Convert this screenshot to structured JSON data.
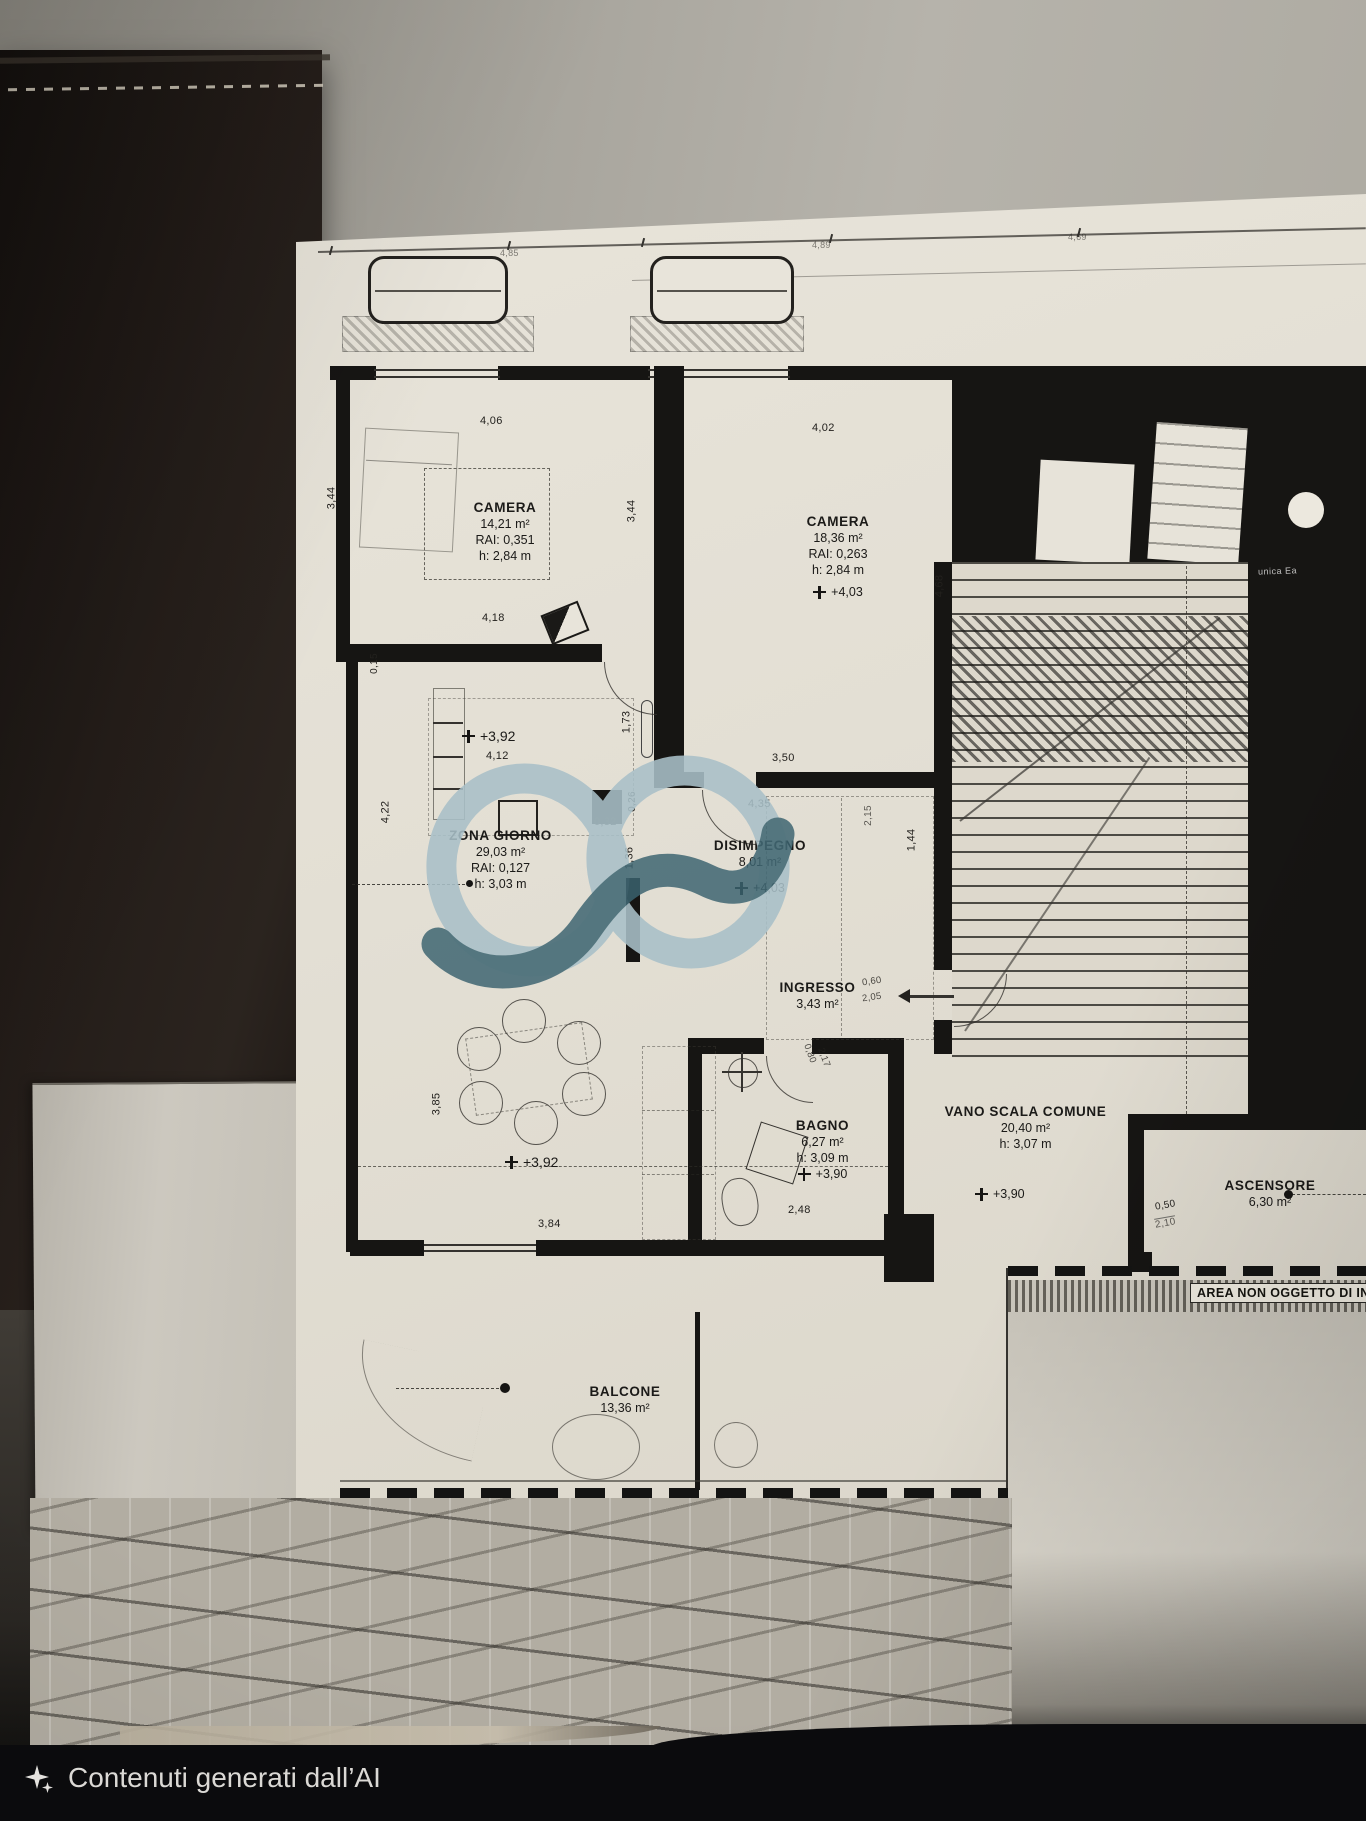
{
  "scene": {
    "caption_text": "Contenuti generati dall’AI",
    "micro_label": "unica Ea"
  },
  "watermark": {
    "light_color": "#a9c0c8",
    "dark_color": "#3b6370"
  },
  "plan": {
    "rooms": {
      "camera1": {
        "name": "CAMERA",
        "area": "14,21 m²",
        "rai": "RAI: 0,351",
        "height": "h: 2,84 m"
      },
      "camera2": {
        "name": "CAMERA",
        "area": "18,36 m²",
        "rai": "RAI: 0,263",
        "height": "h: 2,84 m",
        "quota": "+4,03"
      },
      "zona_giorno": {
        "name": "ZONA GIORNO",
        "area": "29,03 m²",
        "rai": "RAI: 0,127",
        "height": "h: 3,03 m"
      },
      "disimpegno": {
        "name": "DISIMPEGNO",
        "area": "8,01 m²",
        "quota": "+4,03"
      },
      "ingresso": {
        "name": "INGRESSO",
        "area": "3,43 m²"
      },
      "bagno": {
        "name": "BAGNO",
        "area": "6,27 m²",
        "height": "h: 3,09 m",
        "quota": "+3,90"
      },
      "vano_scala": {
        "name": "VANO SCALA COMUNE",
        "area": "20,40 m²",
        "height": "h: 3,07 m",
        "quota": "+3,90"
      },
      "ascensore": {
        "name": "ASCENSORE",
        "area": "6,30 m²"
      },
      "balcone": {
        "name": "BALCONE",
        "area": "13,36 m²"
      }
    },
    "quotas": {
      "zg_top": "+3,92",
      "zg_bottom": "+3,92"
    },
    "dims": {
      "top1": "4,85",
      "top2": "4,89",
      "top3": "4,69",
      "d406": "4,06",
      "d402": "4,02",
      "d344a": "3,44",
      "d344b": "3,44",
      "d418": "4,18",
      "d015": "0,15",
      "d412": "4,12",
      "d173": "1,73",
      "d468": "4,68",
      "d350": "3,50",
      "d026": "0,26",
      "d032": "0,32",
      "d422": "4,22",
      "d435": "4,35",
      "d144": "1,44",
      "d136": "1,36",
      "d215": "2,15",
      "d248": "2,48",
      "d385": "3,85",
      "d384": "3,84"
    },
    "door_labels": {
      "ingresso_w": "0,60",
      "ingresso_h": "2,05",
      "bagno_w": "0,80",
      "bagno_h": "2,17",
      "ascensore_w": "0,50",
      "ascensore_h": "2,10"
    },
    "note_strip": "AREA NON OGGETTO DI INT"
  }
}
